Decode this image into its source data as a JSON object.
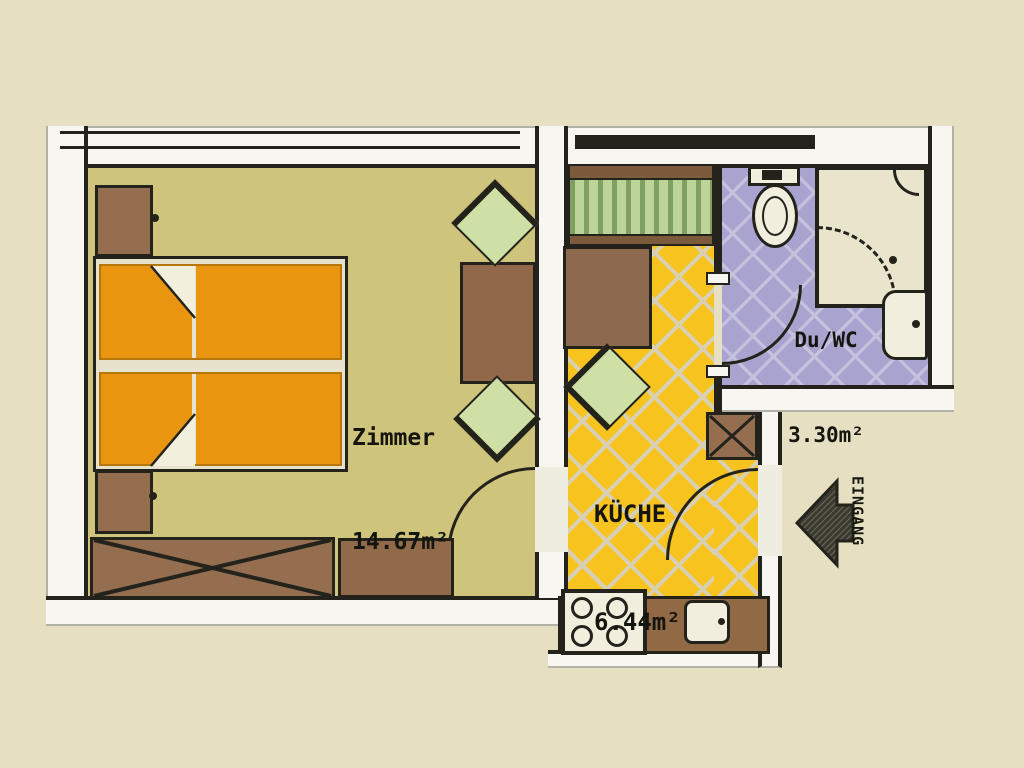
{
  "rooms": {
    "zimmer": {
      "name": "Zimmer",
      "area": "14.67m²"
    },
    "kueche": {
      "name": "KÜCHE",
      "area": "6.44m²"
    },
    "bad": {
      "name": "Du/WC",
      "area": "3.30m²"
    }
  },
  "entrance": {
    "label": "EINGANG",
    "direction": "left"
  },
  "colors": {
    "background": "#e7dfc2",
    "wall_fill": "#f7f6f0",
    "wall_edge": "#23231c",
    "zimmer_floor": "#cfc47b",
    "kitchen_floor": "#f7c41f",
    "kitchen_grout": "#d8d0b4",
    "bath_floor": "#a9a4cf",
    "bed_orange": "#ea950f",
    "furniture_brown": "#956e50",
    "chair_green": "#cfe0a6",
    "window_green": "#bcd49a"
  },
  "furniture_icons": [
    "double-bed-icon",
    "nightstand-icon",
    "wardrobe-x-icon",
    "sideboard-icon",
    "table-icon",
    "chair-icon",
    "kitchen-table-icon",
    "kitchen-shaft-x-icon",
    "kitchen-counter-icon",
    "stove-icon",
    "kitchen-sink-icon",
    "toilet-icon",
    "shower-icon",
    "washbasin-icon",
    "entrance-arrow-icon",
    "window-icon",
    "door-arc-icon"
  ]
}
